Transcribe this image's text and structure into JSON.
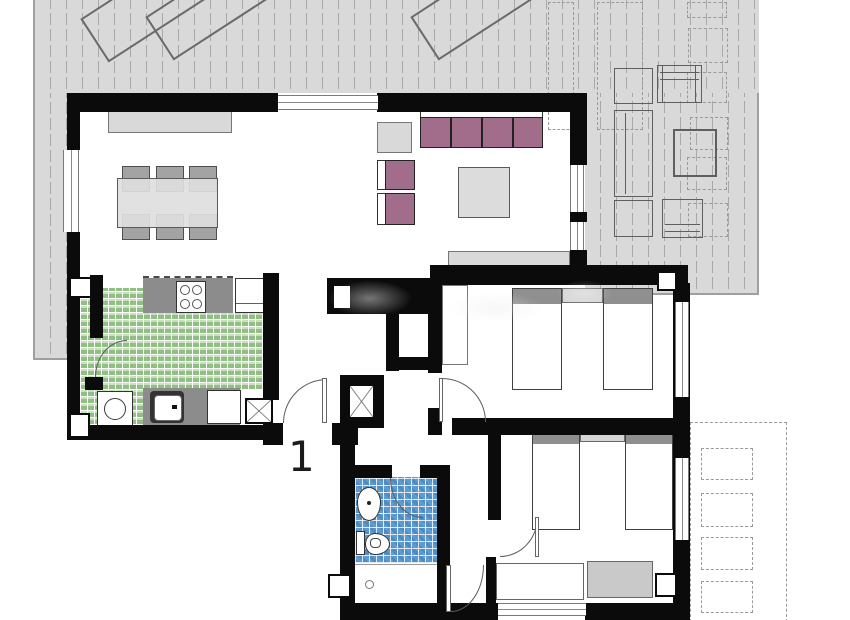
{
  "plan": {
    "unit_label": "1"
  },
  "colors": {
    "wall": "#0b0b0b",
    "terrace": "#d9d9d9",
    "terrace_line": "#a9a9a9",
    "furniture_fill": "#dcdcdc",
    "furniture_border": "#5a5a5a",
    "mauve": "#a26c8b",
    "pillow": "#8f8f8f",
    "counter": "#8c8c8c",
    "tile_green": "#8fbf85",
    "tile_blue": "#5e9bd0",
    "nightstand": "#d6d6d6"
  }
}
